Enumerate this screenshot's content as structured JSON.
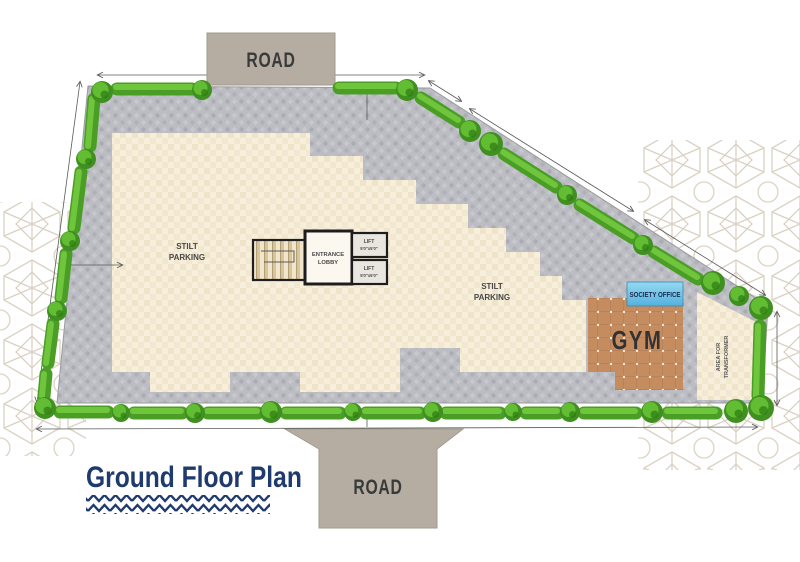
{
  "title": {
    "text": "Ground Floor Plan"
  },
  "roads": {
    "top": "ROAD",
    "bottom": "ROAD"
  },
  "parking": {
    "left": {
      "line1": "STILT",
      "line2": "PARKING"
    },
    "right": {
      "line1": "STILT",
      "line2": "PARKING"
    }
  },
  "core": {
    "lobby": {
      "line1": "ENTRANCE",
      "line2": "LOBBY"
    },
    "lift_upper": {
      "line1": "LIFT",
      "line2": "5'0\"x5'0\""
    },
    "lift_lower": {
      "line1": "LIFT",
      "line2": "5'0\"x5'0\""
    }
  },
  "rooms": {
    "society_office": "SOCIETY OFFICE",
    "gym": "GYM",
    "transformer": {
      "line1": "AREA FOR",
      "line2": "TRANSFORMER"
    }
  },
  "colors": {
    "hedge_green": "#4a9e26",
    "paving_gray": "#bcbdc3",
    "floor_cream": "#f7efdb",
    "gym_floor": "#c58c60",
    "society_blue": "#7fc9e8",
    "road_tan": "#b5ada2",
    "title_navy": "#1e3a6e"
  }
}
